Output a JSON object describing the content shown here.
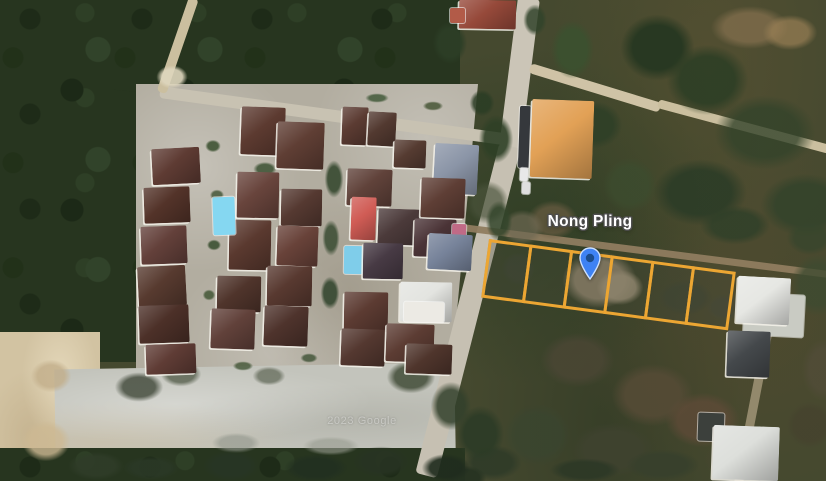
{
  "map": {
    "label": {
      "text": "Nong Pling",
      "x": 590,
      "y": 213,
      "color": "#ffffff"
    },
    "watermark": {
      "text": "2023 Google",
      "x": 362,
      "y": 415
    },
    "marker": {
      "x": 590,
      "y": 280,
      "w": 22,
      "h": 33,
      "body_color": "#3e82f4",
      "border_color": "#cde0fe",
      "dot_color": "#1b4c8c"
    },
    "plots": {
      "x": 489,
      "y": 239,
      "w": 249,
      "h": 59,
      "rot": 7.6,
      "count": 6,
      "stroke": "#eca633",
      "stroke_w": 3,
      "fill": "rgba(68,72,56,0.30)"
    }
  },
  "scene": {
    "patches": [
      {
        "n": "terrain-scrub-right",
        "cls": "scrub",
        "x": 425,
        "y": 0,
        "w": 401,
        "h": 481
      },
      {
        "n": "terrain-forest-left",
        "cls": "forest",
        "x": 0,
        "y": 0,
        "w": 150,
        "h": 362
      },
      {
        "n": "terrain-forest-top",
        "cls": "forest",
        "x": 112,
        "y": 0,
        "w": 348,
        "h": 118,
        "clip": "polygon(0 0,100% 0,100% 100%,0 76%)"
      },
      {
        "n": "housing-estate-ground",
        "cls": "estate",
        "x": 136,
        "y": 84,
        "w": 342,
        "h": 296,
        "clip": "polygon(0 0,100% 0,92% 100%,0 100%)"
      },
      {
        "n": "terrain-dirt-left",
        "cls": "tan",
        "x": 0,
        "y": 332,
        "w": 100,
        "h": 149
      },
      {
        "n": "terrain-gravel-lot",
        "cls": "gravel",
        "x": 55,
        "y": 366,
        "w": 400,
        "h": 92,
        "r": -1
      },
      {
        "n": "terrain-trees-bottom",
        "cls": "forest",
        "x": 0,
        "y": 448,
        "w": 465,
        "h": 33
      }
    ],
    "roads": [
      {
        "n": "main-road",
        "x": 518,
        "y": -2,
        "w": 22,
        "h": 152,
        "r": 7.2,
        "or": "top",
        "c": "#cbc5b7"
      },
      {
        "n": "main-road",
        "x": 499,
        "y": 146,
        "w": 22,
        "h": 340,
        "r": 14.3,
        "or": "top",
        "c": "#c6c0b2"
      },
      {
        "n": "branch-road",
        "x": 530,
        "y": 63,
        "w": 136,
        "h": 10,
        "r": 17,
        "or": "left",
        "c": "#cfc3a6"
      },
      {
        "n": "branch-road",
        "x": 658,
        "y": 99,
        "w": 178,
        "h": 9,
        "r": 15,
        "or": "left",
        "c": "#cbbf9f"
      },
      {
        "n": "dirt-road",
        "x": 462,
        "y": 224,
        "w": 372,
        "h": 7,
        "r": 7.3,
        "or": "left",
        "c": "#8f7c5f",
        "o": 0.95
      },
      {
        "n": "estate-road",
        "x": 160,
        "y": 86,
        "w": 352,
        "h": 12,
        "r": 7.8,
        "or": "left",
        "c": "#c8c2b2"
      },
      {
        "n": "dirt-path",
        "x": 189,
        "y": -2,
        "w": 10,
        "h": 100,
        "r": 19,
        "or": "top",
        "c": "#cbbf9f"
      },
      {
        "n": "dirt-trail",
        "x": 770,
        "y": 298,
        "w": 9,
        "h": 195,
        "r": 11,
        "or": "top",
        "c": "#ac9f82",
        "o": 0.75
      }
    ],
    "blobs": [
      {
        "x": 700,
        "y": 0,
        "w": 100,
        "h": 55,
        "c": "#7d6b4a",
        "o": 0.85
      },
      {
        "x": 755,
        "y": 10,
        "w": 70,
        "h": 45,
        "c": "#997f55",
        "o": 0.7
      },
      {
        "x": 610,
        "y": 5,
        "w": 95,
        "h": 85,
        "c": "#243620",
        "o": 0.9
      },
      {
        "x": 655,
        "y": 35,
        "w": 105,
        "h": 90,
        "c": "#2b3d24",
        "o": 0.85
      },
      {
        "x": 700,
        "y": 85,
        "w": 130,
        "h": 95,
        "c": "#33432a",
        "o": 0.8
      },
      {
        "x": 545,
        "y": 12,
        "w": 55,
        "h": 75,
        "c": "#3a512f",
        "o": 0.85
      },
      {
        "x": 520,
        "y": 0,
        "w": 30,
        "h": 40,
        "c": "#31432a",
        "o": 0.85
      },
      {
        "x": 428,
        "y": 16,
        "w": 44,
        "h": 54,
        "c": "#2c3e26",
        "o": 0.9
      },
      {
        "x": 560,
        "y": 95,
        "w": 70,
        "h": 60,
        "c": "#2c3e26",
        "o": 0.8
      },
      {
        "x": 595,
        "y": 150,
        "w": 70,
        "h": 70,
        "c": "#3c4c2e",
        "o": 0.8
      },
      {
        "x": 640,
        "y": 150,
        "w": 120,
        "h": 85,
        "c": "#2a3b26",
        "o": 0.85
      },
      {
        "x": 748,
        "y": 165,
        "w": 115,
        "h": 80,
        "c": "#31422a",
        "o": 0.8
      },
      {
        "x": 690,
        "y": 200,
        "w": 90,
        "h": 50,
        "c": "#2e3f28",
        "o": 0.8
      },
      {
        "x": 780,
        "y": 215,
        "w": 60,
        "h": 45,
        "c": "#36452c",
        "o": 0.75
      },
      {
        "x": 520,
        "y": 195,
        "w": 65,
        "h": 50,
        "c": "#6a5c42",
        "o": 0.7
      },
      {
        "x": 495,
        "y": 205,
        "w": 55,
        "h": 45,
        "c": "#6e6852",
        "o": 0.7
      },
      {
        "x": 460,
        "y": 175,
        "w": 55,
        "h": 55,
        "c": "#49523a",
        "o": 0.7
      },
      {
        "x": 552,
        "y": 244,
        "w": 95,
        "h": 72,
        "c": "#9b8c74",
        "o": 0.9
      },
      {
        "x": 590,
        "y": 265,
        "w": 60,
        "h": 45,
        "c": "#ab9c82",
        "o": 0.85
      },
      {
        "x": 497,
        "y": 248,
        "w": 42,
        "h": 42,
        "c": "#3c4434",
        "o": 0.6
      },
      {
        "x": 650,
        "y": 275,
        "w": 70,
        "h": 45,
        "c": "#3a4334",
        "o": 0.55
      },
      {
        "x": 700,
        "y": 290,
        "w": 50,
        "h": 35,
        "c": "#44483a",
        "o": 0.5
      },
      {
        "x": 530,
        "y": 325,
        "w": 95,
        "h": 70,
        "c": "#4a4634",
        "o": 0.85
      },
      {
        "x": 600,
        "y": 355,
        "w": 105,
        "h": 80,
        "c": "#564b36",
        "o": 0.85
      },
      {
        "x": 655,
        "y": 385,
        "w": 95,
        "h": 70,
        "c": "#5e4a37",
        "o": 0.8
      },
      {
        "x": 560,
        "y": 415,
        "w": 105,
        "h": 70,
        "c": "#3f422f",
        "o": 0.85
      },
      {
        "x": 695,
        "y": 435,
        "w": 85,
        "h": 50,
        "c": "#46452f",
        "o": 0.85
      },
      {
        "x": 615,
        "y": 445,
        "w": 95,
        "h": 40,
        "c": "#37402c",
        "o": 0.9
      },
      {
        "x": 495,
        "y": 395,
        "w": 85,
        "h": 80,
        "c": "#3a452f",
        "o": 0.85
      },
      {
        "x": 455,
        "y": 440,
        "w": 75,
        "h": 45,
        "c": "#2f3b28",
        "o": 0.9
      },
      {
        "x": 540,
        "y": 455,
        "w": 90,
        "h": 30,
        "c": "#2c3826",
        "o": 0.9
      },
      {
        "x": 783,
        "y": 245,
        "w": 70,
        "h": 80,
        "c": "#3e4b30",
        "o": 0.8
      },
      {
        "x": 795,
        "y": 330,
        "w": 60,
        "h": 80,
        "c": "#514c38",
        "o": 0.8
      },
      {
        "x": 780,
        "y": 395,
        "w": 60,
        "h": 60,
        "c": "#45422e",
        "o": 0.8
      },
      {
        "x": 474,
        "y": 108,
        "w": 44,
        "h": 62,
        "c": "#2e4026",
        "o": 0.9
      },
      {
        "x": 482,
        "y": 195,
        "w": 34,
        "h": 52,
        "c": "#33452b",
        "o": 0.85
      },
      {
        "x": 466,
        "y": 86,
        "w": 32,
        "h": 34,
        "c": "#2a3c24",
        "o": 0.85
      },
      {
        "x": 449,
        "y": 398,
        "w": 62,
        "h": 72,
        "c": "#2c3b26",
        "o": 0.9
      },
      {
        "x": 440,
        "y": 462,
        "w": 52,
        "h": 32,
        "c": "#253221",
        "o": 0.9
      },
      {
        "x": 108,
        "y": 368,
        "w": 62,
        "h": 38,
        "c": "#3e4637",
        "o": 0.8
      },
      {
        "x": 155,
        "y": 358,
        "w": 52,
        "h": 32,
        "c": "#46503c",
        "o": 0.7
      },
      {
        "x": 248,
        "y": 364,
        "w": 42,
        "h": 24,
        "c": "#4a5340",
        "o": 0.6
      },
      {
        "x": 380,
        "y": 356,
        "w": 62,
        "h": 42,
        "c": "#39442f",
        "o": 0.8
      },
      {
        "x": 425,
        "y": 375,
        "w": 52,
        "h": 62,
        "c": "#32402b",
        "o": 0.85
      },
      {
        "x": 205,
        "y": 430,
        "w": 62,
        "h": 26,
        "c": "#90958b",
        "o": 0.6
      },
      {
        "x": 295,
        "y": 434,
        "w": 72,
        "h": 24,
        "c": "#979b8f",
        "o": 0.6
      },
      {
        "x": 25,
        "y": 355,
        "w": 52,
        "h": 42,
        "c": "#c2ae8a",
        "o": 0.8
      },
      {
        "x": 15,
        "y": 415,
        "w": 62,
        "h": 52,
        "c": "#cdb993",
        "o": 0.8
      },
      {
        "x": 60,
        "y": 448,
        "w": 72,
        "h": 36,
        "c": "#2f3c28",
        "o": 0.9
      },
      {
        "x": 115,
        "y": 453,
        "w": 72,
        "h": 30,
        "c": "#2a3826",
        "o": 0.9
      },
      {
        "x": 195,
        "y": 446,
        "w": 72,
        "h": 40,
        "c": "#273524",
        "o": 0.92
      },
      {
        "x": 275,
        "y": 450,
        "w": 82,
        "h": 36,
        "c": "#223020",
        "o": 0.92
      },
      {
        "x": 345,
        "y": 442,
        "w": 72,
        "h": 40,
        "c": "#273322",
        "o": 0.92
      },
      {
        "x": 415,
        "y": 450,
        "w": 62,
        "h": 36,
        "c": "#202c1e",
        "o": 0.92
      },
      {
        "x": 152,
        "y": 62,
        "w": 40,
        "h": 30,
        "c": "#ded6bd",
        "o": 0.9
      },
      {
        "x": 203,
        "y": 138,
        "w": 20,
        "h": 16,
        "c": "#3f5434",
        "o": 0.9
      },
      {
        "x": 208,
        "y": 188,
        "w": 18,
        "h": 14,
        "c": "#46583a",
        "o": 0.85
      },
      {
        "x": 205,
        "y": 238,
        "w": 18,
        "h": 14,
        "c": "#3c5132",
        "o": 0.9
      },
      {
        "x": 201,
        "y": 288,
        "w": 16,
        "h": 14,
        "c": "#435736",
        "o": 0.85
      },
      {
        "x": 250,
        "y": 160,
        "w": 30,
        "h": 18,
        "c": "#3b5132",
        "o": 0.85
      },
      {
        "x": 322,
        "y": 155,
        "w": 24,
        "h": 48,
        "c": "#2f4329",
        "o": 0.85
      },
      {
        "x": 320,
        "y": 215,
        "w": 22,
        "h": 46,
        "c": "#31452b",
        "o": 0.8
      },
      {
        "x": 318,
        "y": 272,
        "w": 24,
        "h": 42,
        "c": "#2e422a",
        "o": 0.85
      },
      {
        "x": 248,
        "y": 112,
        "w": 34,
        "h": 14,
        "c": "#37502f",
        "o": 0.85
      },
      {
        "x": 362,
        "y": 92,
        "w": 30,
        "h": 12,
        "c": "#3b5433",
        "o": 0.8
      },
      {
        "x": 420,
        "y": 100,
        "w": 26,
        "h": 12,
        "c": "#40502f",
        "o": 0.8
      },
      {
        "x": 230,
        "y": 360,
        "w": 26,
        "h": 12,
        "c": "#415435",
        "o": 0.8
      },
      {
        "x": 298,
        "y": 352,
        "w": 22,
        "h": 12,
        "c": "#3d5134",
        "o": 0.8
      }
    ],
    "houses": [
      {
        "n": "house-roof",
        "x": 459,
        "y": 0,
        "w": 57,
        "h": 29,
        "r": 1,
        "c": "#96493a"
      },
      {
        "n": "house-annex",
        "x": 450,
        "y": 8,
        "w": 15,
        "h": 15,
        "r": 0,
        "c": "#b25b48",
        "t": "flat"
      },
      {
        "n": "house-roof",
        "x": 152,
        "y": 148,
        "w": 48,
        "h": 36,
        "r": -3,
        "c": "#5e3b33"
      },
      {
        "n": "house-roof",
        "x": 144,
        "y": 187,
        "w": 46,
        "h": 36,
        "r": -2,
        "c": "#533329"
      },
      {
        "n": "house-roof",
        "x": 141,
        "y": 226,
        "w": 46,
        "h": 38,
        "r": -2,
        "c": "#63403a"
      },
      {
        "n": "house-roof",
        "x": 138,
        "y": 266,
        "w": 48,
        "h": 40,
        "r": -3,
        "c": "#573a2f"
      },
      {
        "n": "house-roof",
        "x": 139,
        "y": 305,
        "w": 50,
        "h": 38,
        "r": -2,
        "c": "#4c3028"
      },
      {
        "n": "house-roof",
        "x": 146,
        "y": 344,
        "w": 50,
        "h": 30,
        "r": -2,
        "c": "#5f3c35"
      },
      {
        "n": "house-roof",
        "x": 241,
        "y": 107,
        "w": 44,
        "h": 48,
        "r": 2,
        "c": "#5c3a30"
      },
      {
        "n": "house-roof",
        "x": 237,
        "y": 172,
        "w": 42,
        "h": 46,
        "r": 1,
        "c": "#68443c"
      },
      {
        "n": "house-roof",
        "x": 229,
        "y": 220,
        "w": 42,
        "h": 50,
        "r": 1,
        "c": "#5a392f"
      },
      {
        "n": "house-roof",
        "x": 217,
        "y": 276,
        "w": 44,
        "h": 36,
        "r": 1,
        "c": "#4f342b"
      },
      {
        "n": "house-roof",
        "x": 211,
        "y": 309,
        "w": 44,
        "h": 40,
        "r": 2,
        "c": "#61413a"
      },
      {
        "n": "swimming-pool",
        "x": 213,
        "y": 197,
        "w": 22,
        "h": 38,
        "r": -2,
        "c": "#85d7f1",
        "t": "flat"
      },
      {
        "n": "house-roof",
        "x": 277,
        "y": 122,
        "w": 47,
        "h": 47,
        "r": 2,
        "c": "#5f3e34"
      },
      {
        "n": "house-roof",
        "x": 281,
        "y": 189,
        "w": 41,
        "h": 37,
        "r": 1,
        "c": "#553931"
      },
      {
        "n": "house-roof",
        "x": 277,
        "y": 226,
        "w": 41,
        "h": 40,
        "r": 2,
        "c": "#684239"
      },
      {
        "n": "house-roof",
        "x": 267,
        "y": 266,
        "w": 45,
        "h": 40,
        "r": 1,
        "c": "#583930"
      },
      {
        "n": "house-roof",
        "x": 264,
        "y": 306,
        "w": 44,
        "h": 40,
        "r": 2,
        "c": "#4e332c"
      },
      {
        "n": "house-roof",
        "x": 342,
        "y": 107,
        "w": 26,
        "h": 38,
        "r": 2,
        "c": "#5b3b32"
      },
      {
        "n": "house-roof",
        "x": 368,
        "y": 112,
        "w": 28,
        "h": 34,
        "r": 3,
        "c": "#523930"
      },
      {
        "n": "house-roof",
        "x": 394,
        "y": 140,
        "w": 32,
        "h": 28,
        "r": 2,
        "c": "#553b31"
      },
      {
        "n": "house-roof",
        "x": 347,
        "y": 169,
        "w": 45,
        "h": 37,
        "r": 2,
        "c": "#60423a"
      },
      {
        "n": "red-roof-house",
        "x": 351,
        "y": 197,
        "w": 25,
        "h": 43,
        "r": 2,
        "c": "#d05c55"
      },
      {
        "n": "house-roof",
        "x": 378,
        "y": 209,
        "w": 44,
        "h": 36,
        "r": 2,
        "c": "#4b3a3a"
      },
      {
        "n": "blue-gray-roof-house",
        "x": 434,
        "y": 144,
        "w": 44,
        "h": 50,
        "r": 3,
        "c": "#8b95a7"
      },
      {
        "n": "house-roof",
        "x": 421,
        "y": 178,
        "w": 44,
        "h": 40,
        "r": 2,
        "c": "#5e3e35"
      },
      {
        "n": "house-roof",
        "x": 414,
        "y": 219,
        "w": 42,
        "h": 38,
        "r": 2,
        "c": "#4a3336"
      },
      {
        "n": "pink-wall",
        "x": 452,
        "y": 224,
        "w": 14,
        "h": 18,
        "r": 2,
        "c": "#c06a86",
        "t": "flat"
      },
      {
        "n": "blue-gray-roof-house",
        "x": 428,
        "y": 234,
        "w": 44,
        "h": 36,
        "r": 3,
        "c": "#77839a"
      },
      {
        "n": "swimming-pool",
        "x": 344,
        "y": 246,
        "w": 19,
        "h": 28,
        "r": 1,
        "c": "#7fcdea",
        "t": "flat"
      },
      {
        "n": "house-roof",
        "x": 363,
        "y": 243,
        "w": 40,
        "h": 36,
        "r": 1,
        "c": "#473a44"
      },
      {
        "n": "house-roof",
        "x": 344,
        "y": 292,
        "w": 44,
        "h": 40,
        "r": 1,
        "c": "#5c3b32"
      },
      {
        "n": "house-roof",
        "x": 341,
        "y": 329,
        "w": 44,
        "h": 37,
        "r": 2,
        "c": "#543830"
      },
      {
        "n": "white-roof-house",
        "x": 400,
        "y": 282,
        "w": 52,
        "h": 40,
        "r": 1,
        "c": "#e3e4e0"
      },
      {
        "n": "white-roof-house",
        "x": 404,
        "y": 302,
        "w": 40,
        "h": 20,
        "r": 1,
        "c": "#eceae4",
        "t": "flat"
      },
      {
        "n": "house-roof",
        "x": 386,
        "y": 324,
        "w": 48,
        "h": 38,
        "r": 2,
        "c": "#5c3c33"
      },
      {
        "n": "house-roof",
        "x": 406,
        "y": 344,
        "w": 46,
        "h": 30,
        "r": 2,
        "c": "#4f352c"
      },
      {
        "n": "parked-cars",
        "x": 519,
        "y": 106,
        "w": 11,
        "h": 62,
        "r": 2,
        "c": "#35383c",
        "t": "flat"
      },
      {
        "n": "parked-car",
        "x": 520,
        "y": 168,
        "w": 8,
        "h": 13,
        "r": 2,
        "c": "#e8e8e8",
        "t": "flat"
      },
      {
        "n": "parked-car",
        "x": 522,
        "y": 182,
        "w": 8,
        "h": 12,
        "r": 2,
        "c": "#dfdfdf",
        "t": "flat"
      },
      {
        "n": "orange-roof-building",
        "x": 531,
        "y": 100,
        "w": 62,
        "h": 78,
        "r": 2,
        "c": "#e2a156"
      },
      {
        "n": "concrete-pad",
        "x": 744,
        "y": 294,
        "w": 60,
        "h": 42,
        "r": 3,
        "c": "#c9cbc3",
        "t": "flat"
      },
      {
        "n": "white-roof-building",
        "x": 737,
        "y": 277,
        "w": 53,
        "h": 47,
        "r": 3,
        "c": "#e6e7e3"
      },
      {
        "n": "dark-roof-building",
        "x": 727,
        "y": 331,
        "w": 43,
        "h": 46,
        "r": 2,
        "c": "#44484b"
      },
      {
        "n": "shed",
        "x": 698,
        "y": 413,
        "w": 26,
        "h": 28,
        "r": 2,
        "c": "#3c403c",
        "t": "flat"
      },
      {
        "n": "white-roof-building",
        "x": 713,
        "y": 426,
        "w": 66,
        "h": 54,
        "r": 2,
        "c": "#dddfdb"
      }
    ]
  }
}
